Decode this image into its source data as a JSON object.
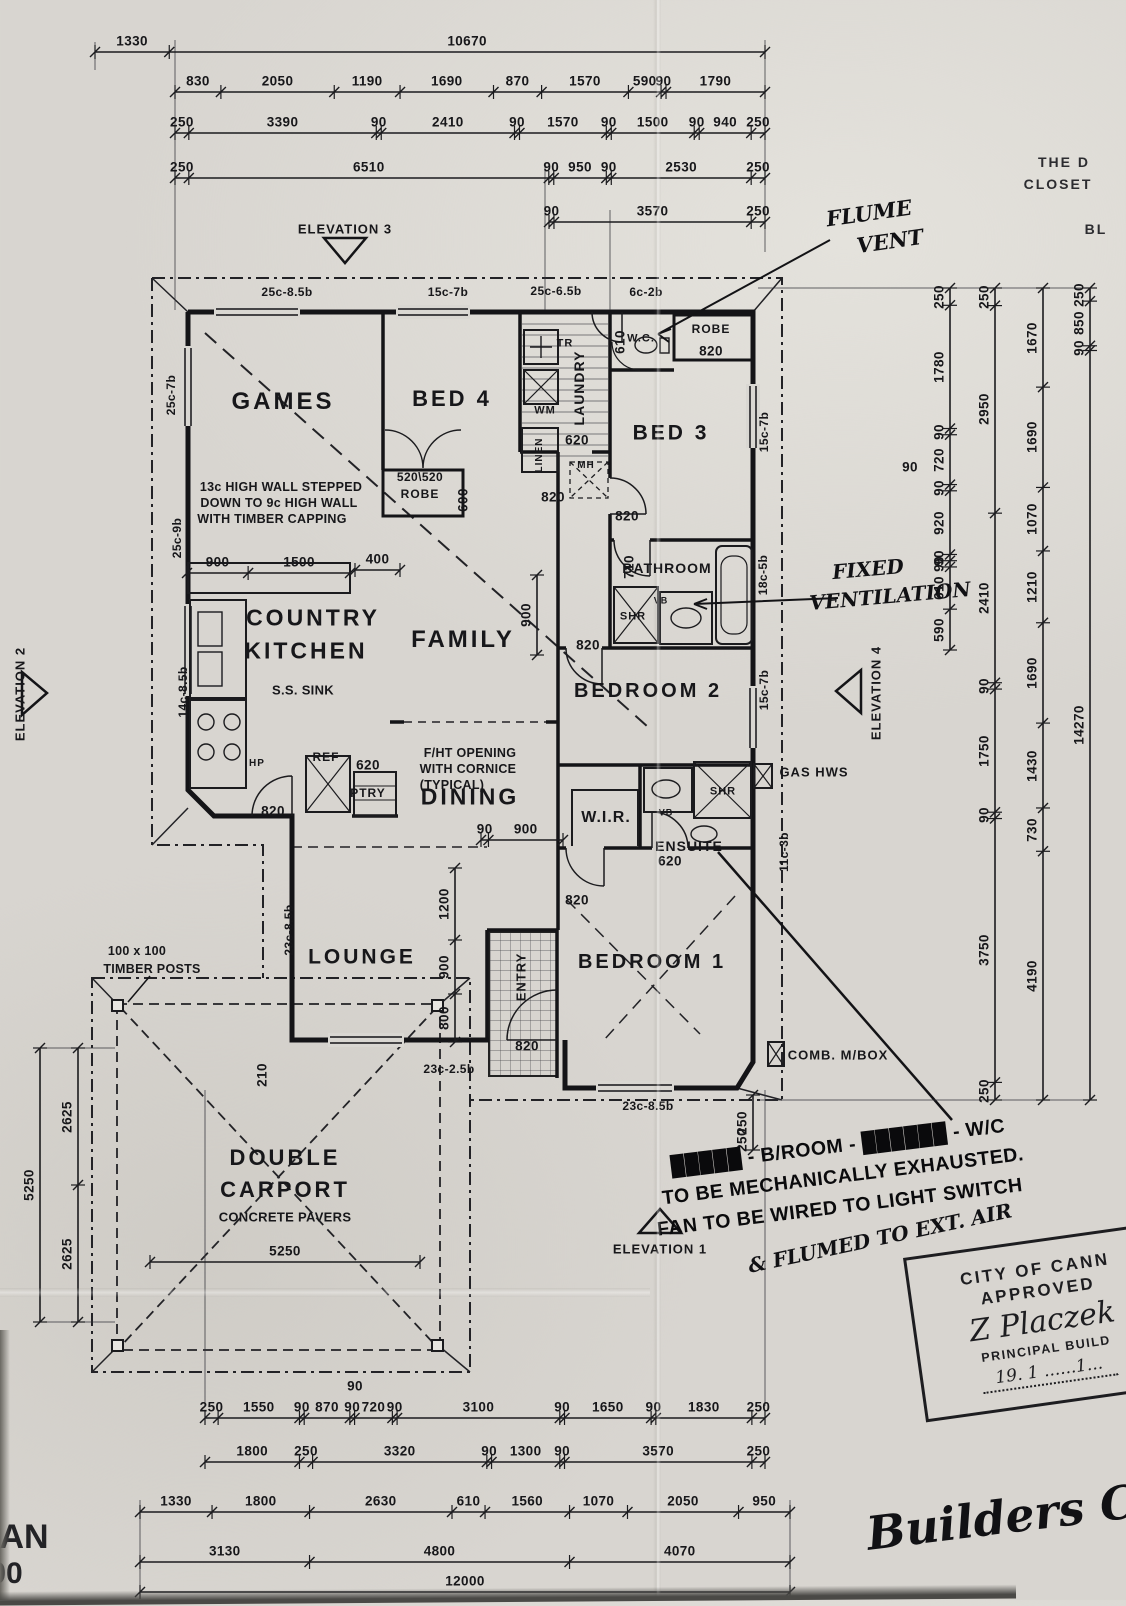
{
  "stamp": {
    "line1": "CITY OF CANN",
    "line2": "APPROVED",
    "signature": "Z Placzek",
    "line3": "PRINCIPAL BUILD",
    "date": "19. 1 ......1..."
  },
  "dims": [
    {
      "o": "h",
      "y": 52,
      "a": 95,
      "b": 765,
      "s": [
        1330,
        10670
      ]
    },
    {
      "o": "h",
      "y": 92,
      "a": 175,
      "b": 765,
      "s": [
        830,
        2050,
        1190,
        1690,
        870,
        1570,
        590,
        90,
        1790
      ]
    },
    {
      "o": "h",
      "y": 133,
      "a": 175,
      "b": 765,
      "s": [
        250,
        3390,
        90,
        2410,
        90,
        1570,
        90,
        1500,
        90,
        940,
        250
      ]
    },
    {
      "o": "h",
      "y": 178,
      "a": 175,
      "b": 765,
      "s": [
        250,
        6510,
        90,
        950,
        90,
        2530,
        250
      ]
    },
    {
      "o": "h",
      "y": 222,
      "a": 549,
      "b": 765,
      "s": [
        90,
        3570,
        250
      ]
    },
    {
      "o": "h",
      "y": 573,
      "a": 187,
      "b": 350,
      "s": [
        900,
        1500
      ]
    },
    {
      "o": "h",
      "y": 570,
      "a": 355,
      "b": 400,
      "s": [
        400
      ]
    },
    {
      "o": "h",
      "y": 840,
      "a": 481,
      "b": 563,
      "s": [
        90,
        900
      ]
    },
    {
      "o": "h",
      "y": 1262,
      "a": 150,
      "b": 420,
      "s": [
        5250
      ]
    },
    {
      "o": "h",
      "y": 1418,
      "a": 205,
      "b": 765,
      "s": [
        250,
        1550,
        90,
        870,
        90,
        720,
        90,
        3100,
        90,
        1650,
        90,
        1830,
        250
      ]
    },
    {
      "o": "h",
      "y": 1462,
      "a": 205,
      "b": 765,
      "s": [
        1800,
        250,
        3320,
        90,
        1300,
        90,
        3570,
        250
      ]
    },
    {
      "o": "h",
      "y": 1512,
      "a": 140,
      "b": 790,
      "s": [
        1330,
        1800,
        2630,
        610,
        1560,
        1070,
        2050,
        950
      ]
    },
    {
      "o": "h",
      "y": 1562,
      "a": 140,
      "b": 790,
      "s": [
        3130,
        4800,
        4070
      ]
    },
    {
      "o": "h",
      "y": 1592,
      "a": 140,
      "b": 790,
      "s": [
        12000
      ]
    },
    {
      "o": "v",
      "x": 950,
      "a": 288,
      "b": 650,
      "s": [
        250,
        1780,
        90,
        720,
        90,
        920,
        90,
        90,
        610,
        590
      ]
    },
    {
      "o": "v",
      "x": 995,
      "a": 288,
      "b": 1100,
      "s": [
        250,
        2950,
        2410,
        90,
        1750,
        90,
        3750,
        250
      ]
    },
    {
      "o": "v",
      "x": 1043,
      "a": 288,
      "b": 1100,
      "s": [
        1670,
        1690,
        1070,
        1210,
        1690,
        1430,
        730,
        4190
      ]
    },
    {
      "o": "v",
      "x": 1090,
      "a": 288,
      "b": 1100,
      "s": [
        250,
        850,
        90,
        14270
      ]
    },
    {
      "o": "v",
      "x": 78,
      "a": 1048,
      "b": 1322,
      "s": [
        2625,
        2625
      ]
    },
    {
      "o": "v",
      "x": 40,
      "a": 1048,
      "b": 1322,
      "s": [
        5250
      ]
    },
    {
      "o": "v",
      "x": 455,
      "a": 868,
      "b": 1042,
      "s": [
        1200,
        900,
        800
      ]
    },
    {
      "o": "v",
      "x": 537,
      "a": 575,
      "b": 655,
      "s": [
        900
      ]
    },
    {
      "o": "v",
      "x": 753,
      "a": 1095,
      "b": 1150,
      "s": [
        250
      ]
    }
  ],
  "labels": [
    {
      "t": "GAMES",
      "x": 283,
      "y": 402,
      "c": "rm",
      "s": 24,
      "n": "room-label-games"
    },
    {
      "t": "BED 4",
      "x": 452,
      "y": 399,
      "c": "rm",
      "s": 22,
      "n": "room-label-bed4"
    },
    {
      "t": "BED 3",
      "x": 671,
      "y": 433,
      "c": "rm",
      "s": 21,
      "n": "room-label-bed3"
    },
    {
      "t": "BEDROOM 2",
      "x": 648,
      "y": 691,
      "c": "rm",
      "s": 20,
      "n": "room-label-bedroom2"
    },
    {
      "t": "BEDROOM 1",
      "x": 652,
      "y": 962,
      "c": "rm",
      "s": 20,
      "n": "room-label-bedroom1"
    },
    {
      "t": "FAMILY",
      "x": 463,
      "y": 640,
      "c": "rm",
      "s": 24,
      "n": "room-label-family"
    },
    {
      "t": "DINING",
      "x": 470,
      "y": 797,
      "c": "rm",
      "s": 23,
      "n": "room-label-dining"
    },
    {
      "t": "LOUNGE",
      "x": 362,
      "y": 957,
      "c": "rm",
      "s": 21,
      "n": "room-label-lounge"
    },
    {
      "t": "COUNTRY",
      "x": 313,
      "y": 618,
      "c": "rm",
      "s": 23,
      "n": "room-label-kitchen-line1"
    },
    {
      "t": "KITCHEN",
      "x": 306,
      "y": 651,
      "c": "rm",
      "s": 23,
      "n": "room-label-kitchen-line2"
    },
    {
      "t": "DOUBLE",
      "x": 285,
      "y": 1158,
      "c": "rm",
      "s": 22,
      "n": "room-label-carport-line1"
    },
    {
      "t": "CARPORT",
      "x": 285,
      "y": 1190,
      "c": "rm",
      "s": 22,
      "n": "room-label-carport-line2"
    },
    {
      "t": "CONCRETE PAVERS",
      "x": 285,
      "y": 1217,
      "c": "nt",
      "s": 13,
      "n": "carport-pavers-note"
    },
    {
      "t": "W.I.R.",
      "x": 606,
      "y": 818,
      "c": "rm-sm",
      "s": 16,
      "n": "room-label-wir"
    },
    {
      "t": "ENSUITE",
      "x": 689,
      "y": 846,
      "c": "rm-sm",
      "s": 14,
      "n": "room-label-ensuite"
    },
    {
      "t": "BATHROOM",
      "x": 667,
      "y": 568,
      "c": "rm-sm",
      "s": 14,
      "n": "room-label-bathroom"
    },
    {
      "t": "LAUNDRY",
      "x": 579,
      "y": 388,
      "c": "rm-sm",
      "s": 14,
      "r": -90,
      "n": "room-label-laundry"
    },
    {
      "t": "ENTRY",
      "x": 521,
      "y": 977,
      "c": "rm-sm",
      "s": 13,
      "r": -90,
      "n": "room-label-entry"
    },
    {
      "t": "W.C.",
      "x": 641,
      "y": 339,
      "c": "rm-sm",
      "s": 11,
      "n": "room-label-wc"
    },
    {
      "t": "ROBE",
      "x": 711,
      "y": 329,
      "c": "rm-sm",
      "s": 12,
      "n": "robe-bed3-label"
    },
    {
      "t": "ROBE",
      "x": 420,
      "y": 494,
      "c": "rm-sm",
      "s": 12,
      "n": "robe-bed4-label"
    },
    {
      "t": "LINEN",
      "x": 540,
      "y": 455,
      "c": "rm-sm",
      "s": 10,
      "r": -90,
      "n": "linen-label"
    },
    {
      "t": "WM",
      "x": 545,
      "y": 411,
      "c": "rm-sm",
      "s": 11,
      "n": "washing-machine-label"
    },
    {
      "t": "TR",
      "x": 565,
      "y": 344,
      "c": "rm-sm",
      "s": 11,
      "n": "trough-label"
    },
    {
      "t": "REF",
      "x": 326,
      "y": 757,
      "c": "rm-sm",
      "s": 12,
      "n": "fridge-label"
    },
    {
      "t": "PTRY",
      "x": 368,
      "y": 793,
      "c": "rm-sm",
      "s": 12,
      "n": "pantry-label"
    },
    {
      "t": "MH",
      "x": 586,
      "y": 466,
      "c": "rm-sm",
      "s": 10,
      "n": "manhole-label"
    },
    {
      "t": "SHR",
      "x": 633,
      "y": 617,
      "c": "rm-sm",
      "s": 11,
      "n": "shower-bathroom-label"
    },
    {
      "t": "VB",
      "x": 661,
      "y": 601,
      "c": "rm-sm",
      "s": 9,
      "n": "vanity-bathroom-label"
    },
    {
      "t": "SHR",
      "x": 723,
      "y": 792,
      "c": "rm-sm",
      "s": 11,
      "n": "shower-ensuite-label"
    },
    {
      "t": "VB",
      "x": 666,
      "y": 813,
      "c": "rm-sm",
      "s": 9,
      "n": "vanity-ensuite-label"
    },
    {
      "t": "HP",
      "x": 257,
      "y": 764,
      "c": "rm-sm",
      "s": 10,
      "n": "hotplate-label"
    },
    {
      "t": "S.S. SINK",
      "x": 303,
      "y": 690,
      "c": "nt",
      "s": 13,
      "n": "sink-label"
    },
    {
      "t": "GAS HWS",
      "x": 814,
      "y": 772,
      "c": "rm-sm",
      "s": 13,
      "n": "gas-hws-label"
    },
    {
      "t": "COMB. M/BOX",
      "x": 838,
      "y": 1055,
      "c": "rm-sm",
      "s": 13,
      "n": "mailbox-label"
    },
    {
      "t": "820",
      "x": 711,
      "y": 351
    },
    {
      "t": "820",
      "x": 553,
      "y": 497
    },
    {
      "t": "820",
      "x": 627,
      "y": 516
    },
    {
      "t": "820",
      "x": 588,
      "y": 645
    },
    {
      "t": "820",
      "x": 273,
      "y": 811
    },
    {
      "t": "820",
      "x": 577,
      "y": 900
    },
    {
      "t": "820",
      "x": 527,
      "y": 1046
    },
    {
      "t": "610",
      "x": 620,
      "y": 342,
      "r": -90
    },
    {
      "t": "710",
      "x": 629,
      "y": 567,
      "r": -90
    },
    {
      "t": "620",
      "x": 577,
      "y": 440
    },
    {
      "t": "620",
      "x": 368,
      "y": 765
    },
    {
      "t": "620",
      "x": 670,
      "y": 861
    },
    {
      "t": "600",
      "x": 463,
      "y": 500,
      "r": -90
    },
    {
      "t": "520\\520",
      "x": 420,
      "y": 477,
      "s": 12
    },
    {
      "t": "210",
      "x": 262,
      "y": 1075,
      "r": -90
    },
    {
      "t": "250",
      "x": 742,
      "y": 1140,
      "r": -90
    },
    {
      "t": "90",
      "x": 910,
      "y": 467
    },
    {
      "t": "90",
      "x": 355,
      "y": 1386
    },
    {
      "t": "25c-8.5b",
      "x": 287,
      "y": 292,
      "c": "wl"
    },
    {
      "t": "15c-7b",
      "x": 448,
      "y": 292,
      "c": "wl"
    },
    {
      "t": "25c-6.5b",
      "x": 556,
      "y": 291,
      "c": "wl"
    },
    {
      "t": "6c-2b",
      "x": 646,
      "y": 292,
      "c": "wl"
    },
    {
      "t": "25c-7b",
      "x": 171,
      "y": 395,
      "c": "wl",
      "r": -90
    },
    {
      "t": "25c-9b",
      "x": 177,
      "y": 538,
      "c": "wl",
      "r": -90
    },
    {
      "t": "14c-8.5b",
      "x": 183,
      "y": 692,
      "c": "wl",
      "r": -90
    },
    {
      "t": "15c-7b",
      "x": 764,
      "y": 432,
      "c": "wl",
      "r": -90
    },
    {
      "t": "18c-5b",
      "x": 763,
      "y": 575,
      "c": "wl",
      "r": -90
    },
    {
      "t": "15c-7b",
      "x": 764,
      "y": 690,
      "c": "wl",
      "r": -90
    },
    {
      "t": "11c-3b",
      "x": 784,
      "y": 852,
      "c": "wl",
      "r": -90
    },
    {
      "t": "23c-8.5b",
      "x": 289,
      "y": 930,
      "c": "wl",
      "r": -90
    },
    {
      "t": "23c-2.5b",
      "x": 449,
      "y": 1069,
      "c": "wl"
    },
    {
      "t": "23c-8.5b",
      "x": 648,
      "y": 1106,
      "c": "wl"
    },
    {
      "t": "13c HIGH WALL STEPPED",
      "x": 281,
      "y": 487,
      "c": "nt",
      "n": "ceiling-note-line1"
    },
    {
      "t": "DOWN TO 9c HIGH WALL",
      "x": 279,
      "y": 503,
      "c": "nt",
      "n": "ceiling-note-line2"
    },
    {
      "t": "WITH TIMBER CAPPING",
      "x": 272,
      "y": 519,
      "c": "nt",
      "n": "ceiling-note-line3"
    },
    {
      "t": "F/HT OPENING",
      "x": 470,
      "y": 753,
      "c": "nt",
      "n": "fht-note-line1"
    },
    {
      "t": "WITH CORNICE",
      "x": 468,
      "y": 769,
      "c": "nt",
      "n": "fht-note-line2"
    },
    {
      "t": "(TYPICAL)",
      "x": 452,
      "y": 785,
      "c": "nt",
      "n": "fht-note-line3"
    },
    {
      "t": "100 x 100",
      "x": 137,
      "y": 951,
      "c": "nt",
      "n": "timber-posts-note-line1"
    },
    {
      "t": "TIMBER POSTS",
      "x": 152,
      "y": 969,
      "c": "nt",
      "n": "timber-posts-note-line2"
    },
    {
      "t": "ELEVATION 3",
      "x": 345,
      "y": 229,
      "c": "el",
      "n": "elevation-3-label"
    },
    {
      "t": "ELEVATION 1",
      "x": 660,
      "y": 1249,
      "c": "el",
      "n": "elevation-1-label"
    },
    {
      "t": "ELEVATION 2",
      "x": 20,
      "y": 694,
      "c": "el",
      "r": -90,
      "n": "elevation-2-label"
    },
    {
      "t": "ELEVATION 4",
      "x": 876,
      "y": 693,
      "c": "el",
      "r": -90,
      "n": "elevation-4-label"
    },
    {
      "t": "THE D",
      "x": 1064,
      "y": 162,
      "c": "fr",
      "n": "edge-fragment-1"
    },
    {
      "t": "CLOSET",
      "x": 1058,
      "y": 184,
      "c": "fr",
      "n": "edge-fragment-2"
    },
    {
      "t": "BL",
      "x": 1096,
      "y": 229,
      "c": "fr",
      "n": "edge-fragment-3"
    },
    {
      "t": "AN",
      "x": 24,
      "y": 1537,
      "c": "big",
      "n": "corner-fragment-plan"
    },
    {
      "t": "00",
      "x": 6,
      "y": 1574,
      "c": "big",
      "s": 30,
      "n": "corner-fragment-scale"
    },
    {
      "t": "FLUME",
      "x": 869,
      "y": 213,
      "c": "hd",
      "r": -8,
      "s": 21,
      "n": "handwritten-flume-vent-1"
    },
    {
      "t": "VENT",
      "x": 890,
      "y": 241,
      "c": "hd",
      "r": -8,
      "s": 21,
      "n": "handwritten-flume-vent-2"
    },
    {
      "t": "FIXED",
      "x": 868,
      "y": 569,
      "c": "hd",
      "r": -5,
      "n": "handwritten-fixed-vent-1"
    },
    {
      "t": "VENTILATION",
      "x": 890,
      "y": 596,
      "c": "hd",
      "r": -5,
      "n": "handwritten-fixed-vent-2"
    },
    {
      "t": "& FLUMED TO EXT. AIR",
      "x": 880,
      "y": 1238,
      "c": "hd",
      "r": -12,
      "n": "handwritten-flumed-ext-air"
    },
    {
      "t": "Builders Copy",
      "x": 1046,
      "y": 1512,
      "c": "hd",
      "r": -7,
      "s": 46,
      "n": "handwritten-builders-copy"
    },
    {
      "t": "█████ - B/ROOM - ██████ - W/C",
      "x": 838,
      "y": 1147,
      "c": "sn",
      "r": -7,
      "n": "stamped-note-line1"
    },
    {
      "t": "TO BE MECHANICALLY EXHAUSTED.",
      "x": 843,
      "y": 1177,
      "c": "sn",
      "r": -7,
      "n": "stamped-note-line2"
    },
    {
      "t": "FAN TO BE WIRED TO LIGHT SWITCH",
      "x": 840,
      "y": 1208,
      "c": "sn",
      "r": -7,
      "n": "stamped-note-line3"
    }
  ]
}
